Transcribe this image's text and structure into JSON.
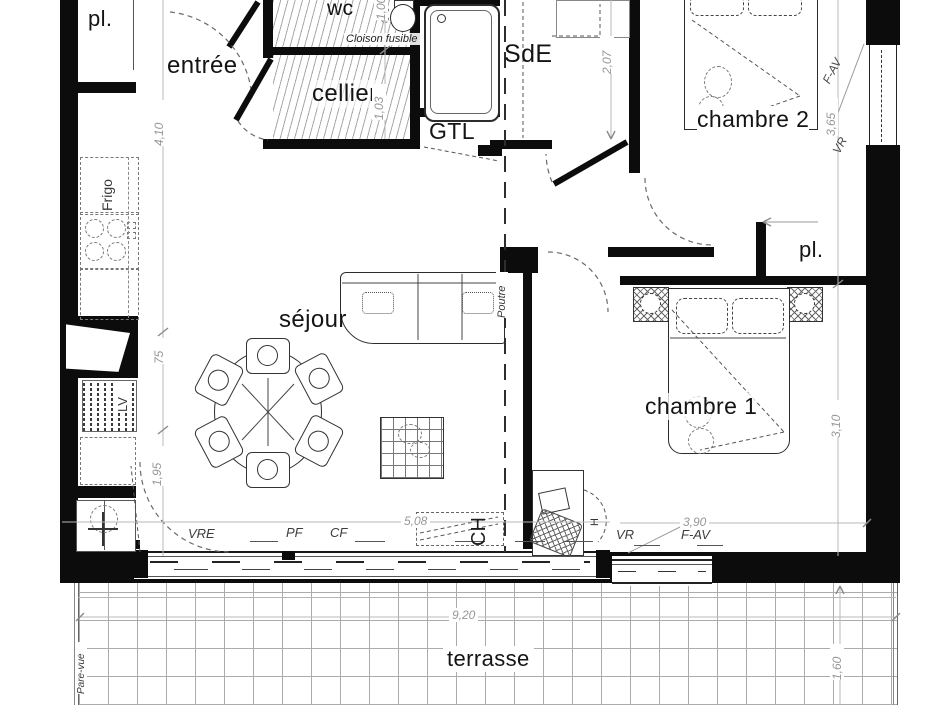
{
  "plan": {
    "rooms": {
      "pl_top": "pl.",
      "wc": "wc",
      "entree": "entrée",
      "cellier": "cellier",
      "sde": "SdE",
      "gtl": "GTL",
      "chambre2": "chambre 2",
      "sejour": "séjour",
      "pl_right": "pl.",
      "chambre1": "chambre 1",
      "terrasse": "terrasse"
    },
    "annotations": {
      "cloison_fusible": "Cloison fusible",
      "poutre": "Poutre",
      "frigo": "Frigo",
      "lave_vaisselle": "LV",
      "chauffage": "CH",
      "h_mark": "H",
      "pare_vue": "Pare-vue"
    },
    "openings": {
      "vre": "VRE",
      "pf": "PF",
      "cf": "CF",
      "vr_chambre1": "VR",
      "fav_chambre1": "F-AV",
      "vr_chambre2": "VR",
      "fav_chambre2": "F-AV"
    },
    "dimensions": {
      "entree_depth": "4,10",
      "kitchen_width": "75",
      "sejour_left": "1,95",
      "wc_width": "1,00",
      "cellier_width": "1,03",
      "sde_depth": "2,07",
      "chambre2_depth": "3,65",
      "chambre1_depth": "3,10",
      "bay_width": "5,08",
      "chambre1_width": "3,90",
      "terrasse_width": "9,20",
      "terrasse_depth": "1,60"
    }
  }
}
